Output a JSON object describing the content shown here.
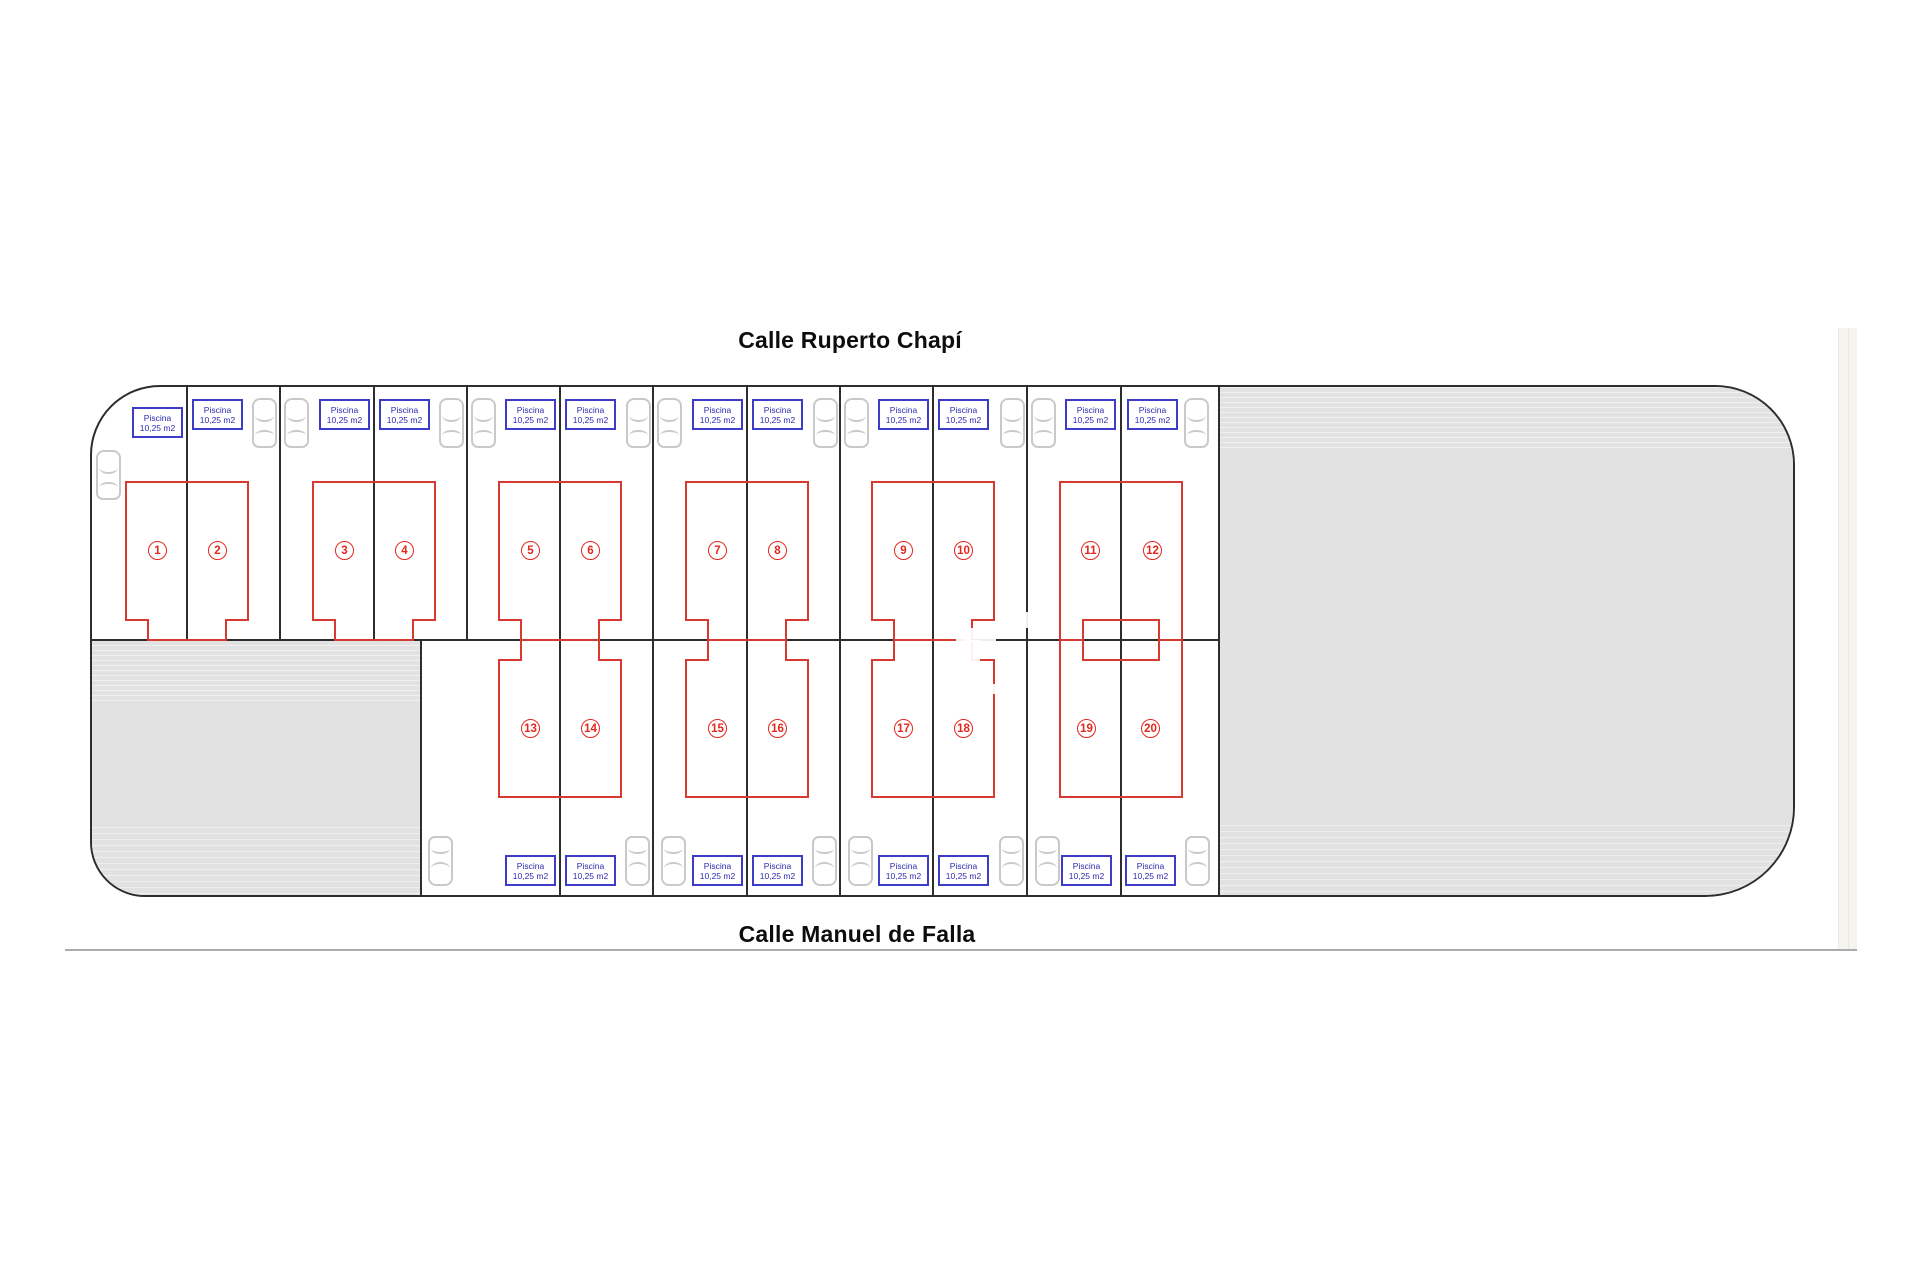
{
  "titles": {
    "top": "Calle Ruperto Chapí",
    "bottom": "Calle Manuel de Falla"
  },
  "pool_label": {
    "line1": "Piscina",
    "line2": "10,25 m2"
  },
  "colors": {
    "line_ink": "#2d2d2d",
    "building_red": "#d63a31",
    "number_red": "#e2271d",
    "pool_blue": "#3c3cc8",
    "pool_text_blue": "#2a2ab2",
    "parking_gray": "#e2e2e2",
    "car_gray": "#c9c9c9",
    "street_line_gray": "#ababab",
    "roadside_strip": "#f5f4ef",
    "background": "#ffffff"
  },
  "site": {
    "x": 90,
    "y": 385,
    "width": 1705,
    "height": 512
  },
  "rows": {
    "mid_y": 640,
    "top": {
      "building_top": 482,
      "building_bottom": 620,
      "pool_y": 399,
      "number_y": 550,
      "car_y": 398
    },
    "bottom": {
      "building_top": 660,
      "building_bottom": 797,
      "pool_y": 855,
      "number_y": 728,
      "car_y": 836
    }
  },
  "plots": {
    "top_dividers": [
      187,
      280,
      374,
      467,
      560,
      653,
      747,
      840,
      933,
      1027,
      1121
    ],
    "bottom_dividers": [
      560,
      653,
      747,
      840,
      933,
      1027,
      1121
    ],
    "right_edge": 1218,
    "left_parking": {
      "x": 90,
      "y": 640,
      "w": 330,
      "h": 257
    },
    "right_parking_x": 1218
  },
  "duplexes": [
    {
      "row": "top",
      "units": "1-2",
      "divider": 187,
      "porch": "center"
    },
    {
      "row": "top",
      "units": "3-4",
      "divider": 374,
      "porch": "center"
    },
    {
      "row": "top",
      "units": "5-6",
      "divider": 560,
      "porch": "center"
    },
    {
      "row": "top",
      "units": "7-8",
      "divider": 747,
      "porch": "center"
    },
    {
      "row": "top",
      "units": "9-10",
      "divider": 933,
      "porch": "center"
    },
    {
      "row": "top",
      "units": "11-12",
      "divider": 1121,
      "porch": "outer"
    },
    {
      "row": "bottom",
      "units": "13-14",
      "divider": 560,
      "porch": "center"
    },
    {
      "row": "bottom",
      "units": "15-16",
      "divider": 747,
      "porch": "center"
    },
    {
      "row": "bottom",
      "units": "17-18",
      "divider": 933,
      "porch": "center"
    },
    {
      "row": "bottom",
      "units": "19-20",
      "divider": 1121,
      "porch": "outer"
    }
  ],
  "units": [
    {
      "number": "1",
      "cx": 157,
      "row": "top",
      "pool_y": 407
    },
    {
      "number": "2",
      "cx": 217,
      "row": "top"
    },
    {
      "number": "3",
      "cx": 344,
      "row": "top"
    },
    {
      "number": "4",
      "cx": 404,
      "row": "top"
    },
    {
      "number": "5",
      "cx": 530,
      "row": "top"
    },
    {
      "number": "6",
      "cx": 590,
      "row": "top"
    },
    {
      "number": "7",
      "cx": 717,
      "row": "top"
    },
    {
      "number": "8",
      "cx": 777,
      "row": "top"
    },
    {
      "number": "9",
      "cx": 903,
      "row": "top"
    },
    {
      "number": "10",
      "cx": 963,
      "row": "top"
    },
    {
      "number": "11",
      "cx": 1090,
      "row": "top"
    },
    {
      "number": "12",
      "cx": 1152,
      "row": "top"
    },
    {
      "number": "13",
      "cx": 530,
      "row": "bottom"
    },
    {
      "number": "14",
      "cx": 590,
      "row": "bottom"
    },
    {
      "number": "15",
      "cx": 717,
      "row": "bottom"
    },
    {
      "number": "16",
      "cx": 777,
      "row": "bottom"
    },
    {
      "number": "17",
      "cx": 903,
      "row": "bottom"
    },
    {
      "number": "18",
      "cx": 963,
      "row": "bottom"
    },
    {
      "number": "19",
      "cx": 1086,
      "row": "bottom"
    },
    {
      "number": "20",
      "cx": 1150,
      "row": "bottom"
    }
  ],
  "building_shape": {
    "half_width": 61,
    "porch_half_width": 39,
    "outer_porch_width": 23
  },
  "cars": [
    {
      "cx": 108,
      "row": "top",
      "y": 450
    },
    {
      "cx": 264,
      "row": "top"
    },
    {
      "cx": 296,
      "row": "top"
    },
    {
      "cx": 451,
      "row": "top"
    },
    {
      "cx": 483,
      "row": "top"
    },
    {
      "cx": 638,
      "row": "top"
    },
    {
      "cx": 669,
      "row": "top"
    },
    {
      "cx": 825,
      "row": "top"
    },
    {
      "cx": 856,
      "row": "top"
    },
    {
      "cx": 1012,
      "row": "top"
    },
    {
      "cx": 1043,
      "row": "top"
    },
    {
      "cx": 1196,
      "row": "top"
    },
    {
      "cx": 440,
      "row": "bottom"
    },
    {
      "cx": 637,
      "row": "bottom"
    },
    {
      "cx": 673,
      "row": "bottom"
    },
    {
      "cx": 824,
      "row": "bottom"
    },
    {
      "cx": 860,
      "row": "bottom"
    },
    {
      "cx": 1011,
      "row": "bottom"
    },
    {
      "cx": 1047,
      "row": "bottom"
    },
    {
      "cx": 1197,
      "row": "bottom"
    }
  ],
  "roadside_strip": {
    "x": 1838,
    "y": 328,
    "w": 18,
    "h": 621
  },
  "street_line": {
    "x": 65,
    "y": 949,
    "w": 1792
  },
  "artifacts": [
    {
      "x": 956,
      "y": 586,
      "w": 14,
      "h": 62
    },
    {
      "x": 998,
      "y": 612,
      "w": 34,
      "h": 16
    },
    {
      "x": 966,
      "y": 628,
      "w": 30,
      "h": 14
    },
    {
      "x": 970,
      "y": 640,
      "w": 10,
      "h": 64
    },
    {
      "x": 986,
      "y": 684,
      "w": 36,
      "h": 10
    },
    {
      "x": 938,
      "y": 698,
      "w": 24,
      "h": 12
    }
  ]
}
